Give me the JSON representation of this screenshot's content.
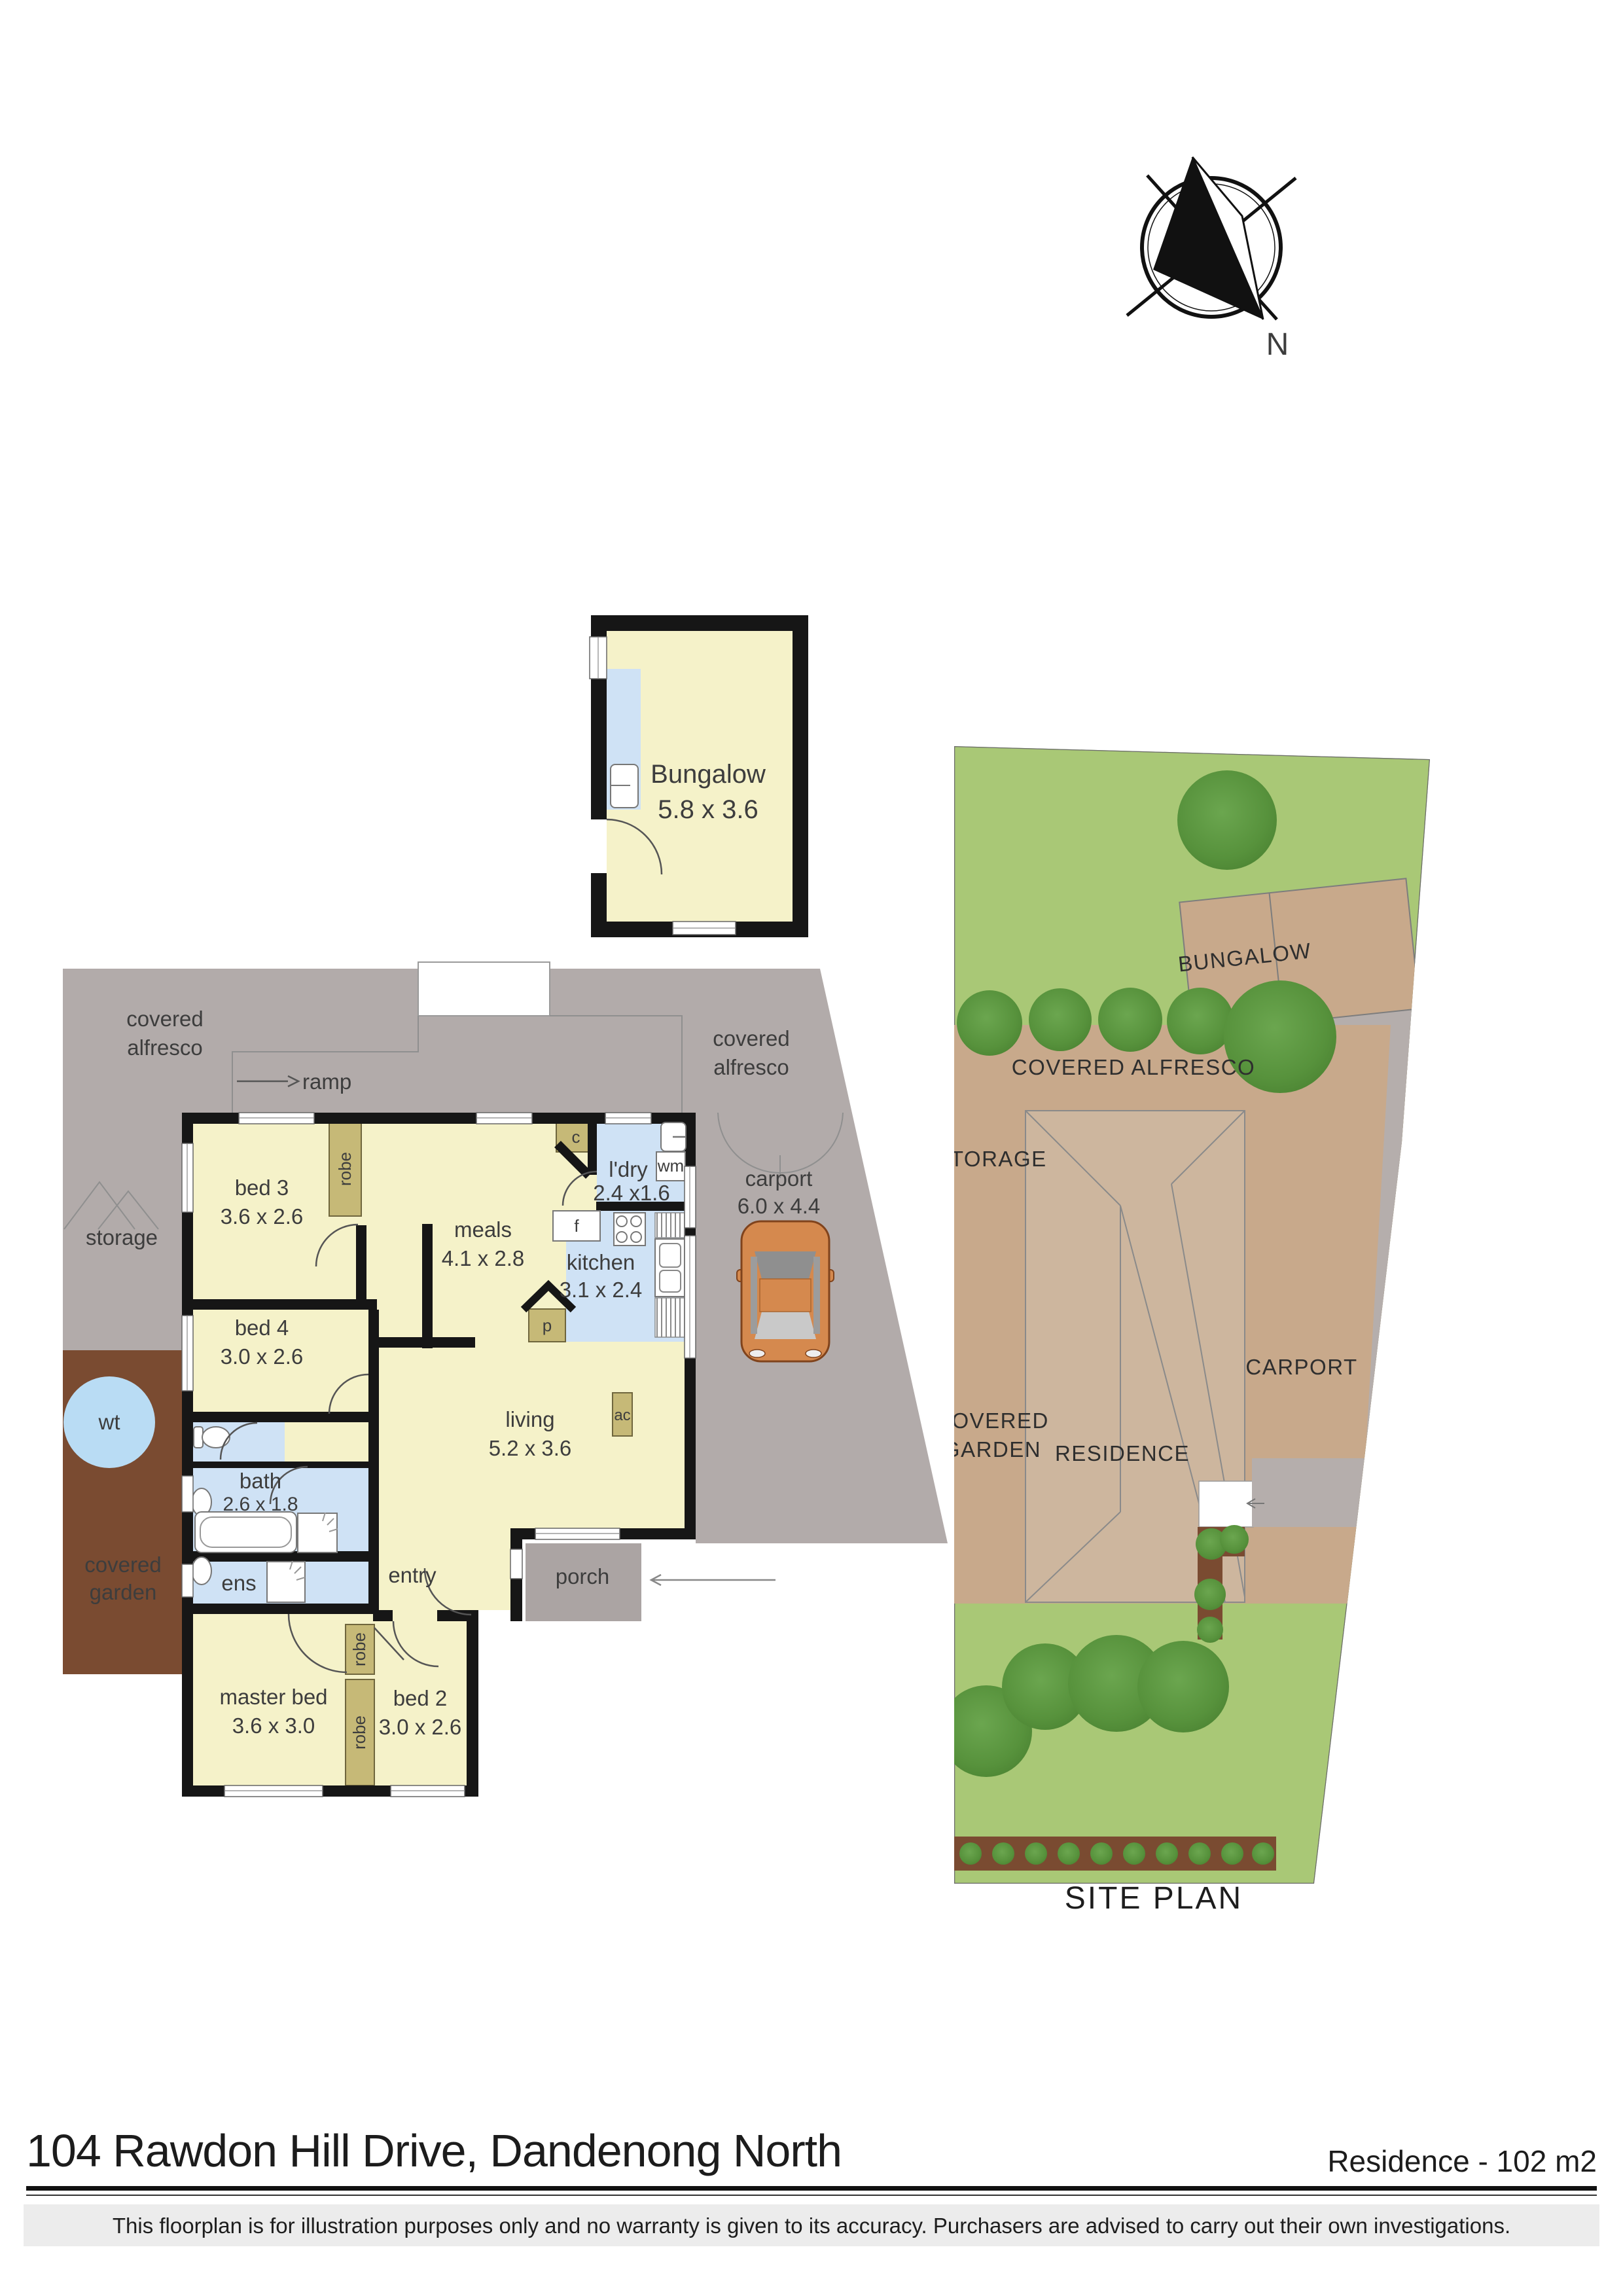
{
  "compass": {
    "north_label": "N"
  },
  "bungalow": {
    "name": "Bungalow",
    "dims": "5.8 x 3.6"
  },
  "floorplan": {
    "rooms": [
      {
        "name": "bed 3",
        "dims": "3.6 x 2.6"
      },
      {
        "name": "bed 4",
        "dims": "3.0 x 2.6"
      },
      {
        "name": "meals",
        "dims": "4.1 x 2.8"
      },
      {
        "name": "l'dry",
        "dims": "2.4 x1.6"
      },
      {
        "name": "kitchen",
        "dims": "3.1 x 2.4"
      },
      {
        "name": "living",
        "dims": "5.2 x 3.6"
      },
      {
        "name": "bath",
        "dims": "2.6 x 1.8"
      },
      {
        "name": "ens"
      },
      {
        "name": "master bed",
        "dims": "3.6 x 3.0"
      },
      {
        "name": "bed 2",
        "dims": "3.0 x 2.6"
      },
      {
        "name": "carport",
        "dims": "6.0 x 4.4"
      }
    ],
    "areas": {
      "covered_alfresco_line1": "covered",
      "covered_alfresco_line2": "alfresco",
      "storage": "storage",
      "covered_garden_line1": "covered",
      "covered_garden_line2": "garden",
      "water_tank": "wt",
      "entry": "entry",
      "porch": "porch",
      "ramp": "ramp"
    },
    "fixtures": {
      "robe": "robe",
      "cupboard": "c",
      "fridge": "f",
      "pantry": "p",
      "washing_machine": "wm",
      "air_conditioner": "ac"
    }
  },
  "site_plan": {
    "labels": {
      "bungalow": "BUNGALOW",
      "covered_alfresco": "COVERED ALFRESCO",
      "storage": "STORAGE",
      "covered_garden_line1": "COVERED",
      "covered_garden_line2": "GARDEN",
      "residence": "RESIDENCE",
      "carport": "CARPORT",
      "title": "SITE PLAN"
    }
  },
  "footer": {
    "address": "104 Rawdon Hill Drive, Dandenong North",
    "area_note": "Residence - 102 m2",
    "disclaimer": "This floorplan is for illustration purposes only and no warranty is given to its accuracy. Purchasers are advised to carry out their own investigations."
  },
  "colors": {
    "floor_cream": "#f5f2c9",
    "wet_blue": "#cfe2f5",
    "alfresco_gray": "#b2abaa",
    "garden_brown": "#7a4b31",
    "robe_olive": "#c6b977",
    "site_green": "#a9c876",
    "site_tan": "#c8a98b",
    "tree_green": "#57923c",
    "car_orange": "#d5894e",
    "wall_black": "#161616"
  }
}
